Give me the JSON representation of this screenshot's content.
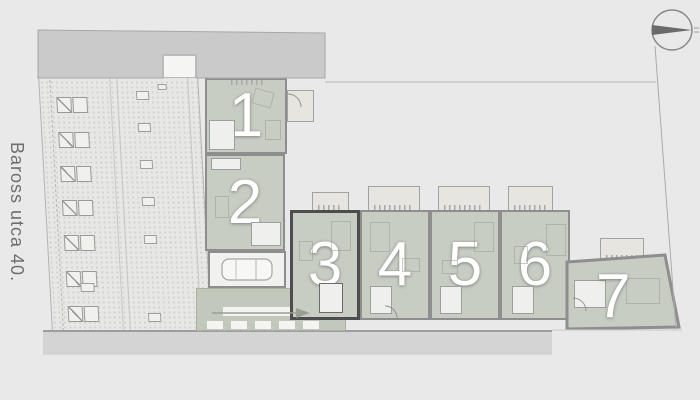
{
  "street_label": "Baross utca 40.",
  "units": [
    {
      "id": "1",
      "label": "1",
      "highlighted": false
    },
    {
      "id": "2",
      "label": "2",
      "highlighted": false
    },
    {
      "id": "3",
      "label": "3",
      "highlighted": true
    },
    {
      "id": "4",
      "label": "4",
      "highlighted": false
    },
    {
      "id": "5",
      "label": "5",
      "highlighted": false
    },
    {
      "id": "6",
      "label": "6",
      "highlighted": false
    },
    {
      "id": "7",
      "label": "7",
      "highlighted": false
    }
  ],
  "icons": {
    "compass": "north-arrow-icon",
    "driveway_arrow": "arrow-right-icon",
    "car": "car-icon"
  },
  "colors": {
    "background": "#e9e9e9",
    "unit_fill": "#c7cdc3",
    "unit_wall": "#8e8e8e",
    "highlight_wall": "#4d4d4d",
    "neighbor_band": "#cacaca",
    "sidewalk": "#d4d4d4",
    "terrace": "#e6e5e0",
    "driveway": "#c3c8bc",
    "unit_number_text": "#ffffff",
    "street_text": "#6f6f6f"
  }
}
